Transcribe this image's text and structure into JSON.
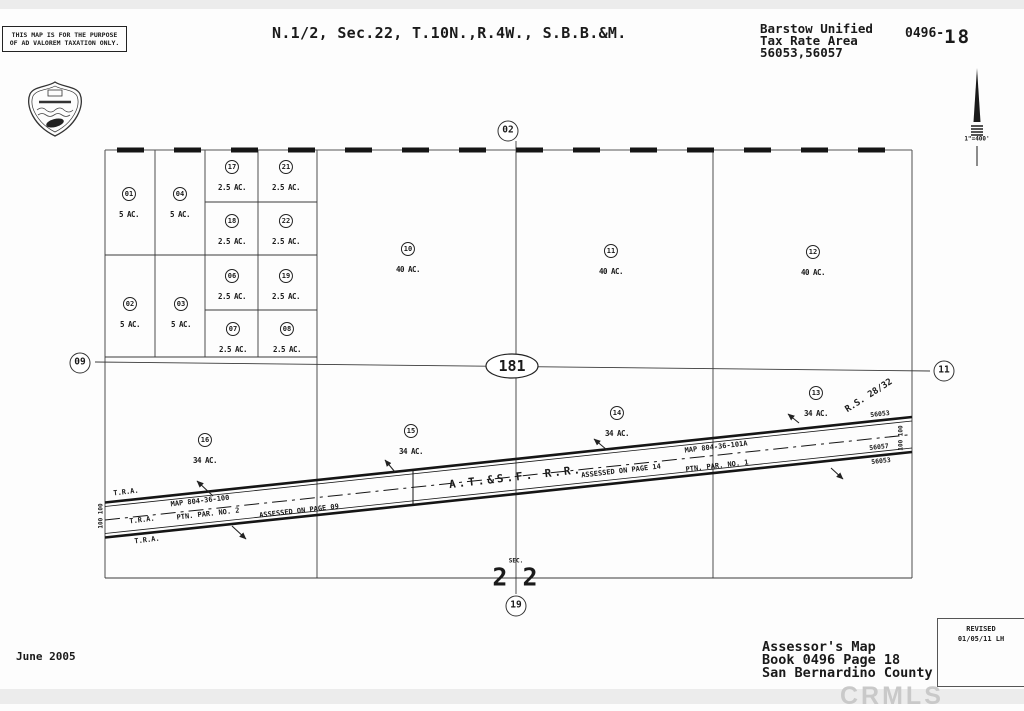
{
  "header": {
    "disclaimer1": "THIS MAP IS FOR THE PURPOSE",
    "disclaimer2": "OF AD VALOREM TAXATION ONLY.",
    "title": "N.1/2, Sec.22, T.10N.,R.4W., S.B.B.&M.",
    "district": "Barstow Unified",
    "tax_rate_area": "Tax Rate Area",
    "tra_codes": "56053,56057",
    "book_page_prefix": "0496-",
    "book_page_number": "18",
    "scale": "1\"=400'"
  },
  "map": {
    "adjacent": {
      "top": "02",
      "left": "09",
      "right": "11",
      "bottom": "19"
    },
    "center_marker": "181",
    "sec_label": "SEC.",
    "sec_number": "2 2",
    "parcels": [
      {
        "num": "01",
        "area": "5 AC."
      },
      {
        "num": "04",
        "area": "5 AC."
      },
      {
        "num": "02",
        "area": "5 AC."
      },
      {
        "num": "03",
        "area": "5 AC."
      },
      {
        "num": "17",
        "area": "2.5 AC."
      },
      {
        "num": "21",
        "area": "2.5 AC."
      },
      {
        "num": "18",
        "area": "2.5 AC."
      },
      {
        "num": "22",
        "area": "2.5 AC."
      },
      {
        "num": "06",
        "area": "2.5 AC."
      },
      {
        "num": "19",
        "area": "2.5 AC."
      },
      {
        "num": "07",
        "area": "2.5 AC."
      },
      {
        "num": "08",
        "area": "2.5 AC."
      },
      {
        "num": "10",
        "area": "40 AC."
      },
      {
        "num": "11",
        "area": "40 AC."
      },
      {
        "num": "12",
        "area": "40 AC."
      },
      {
        "num": "16",
        "area": "34 AC."
      },
      {
        "num": "15",
        "area": "34 AC."
      },
      {
        "num": "14",
        "area": "34 AC."
      },
      {
        "num": "13",
        "area": "34 AC."
      }
    ],
    "railroad": {
      "name": "A.T.&S.F. R.R.",
      "map_ref_left": "MAP 804-36-100",
      "par_ref_left": "PTN. PAR. NO. 2",
      "assessed_left": "ASSESSED ON PAGE 09",
      "map_ref_right": "MAP 804-36-101A",
      "par_ref_right": "PTN. PAR. NO. 1",
      "assessed_right": "ASSESSED ON PAGE 14",
      "tra": "T.R.A.",
      "row_width": "100 100",
      "survey_ref": "R.S. 28/32",
      "tra_code_top": "56053",
      "tra_code_mid": "56057",
      "tra_code_bottom": "56053"
    }
  },
  "footer": {
    "date": "June 2005",
    "assessor1": "Assessor's Map",
    "assessor2": "Book 0496 Page 18",
    "assessor3": "San Bernardino County",
    "revised_label": "REVISED",
    "revised_date": "01/05/11 LH",
    "watermark": "CRMLS"
  }
}
